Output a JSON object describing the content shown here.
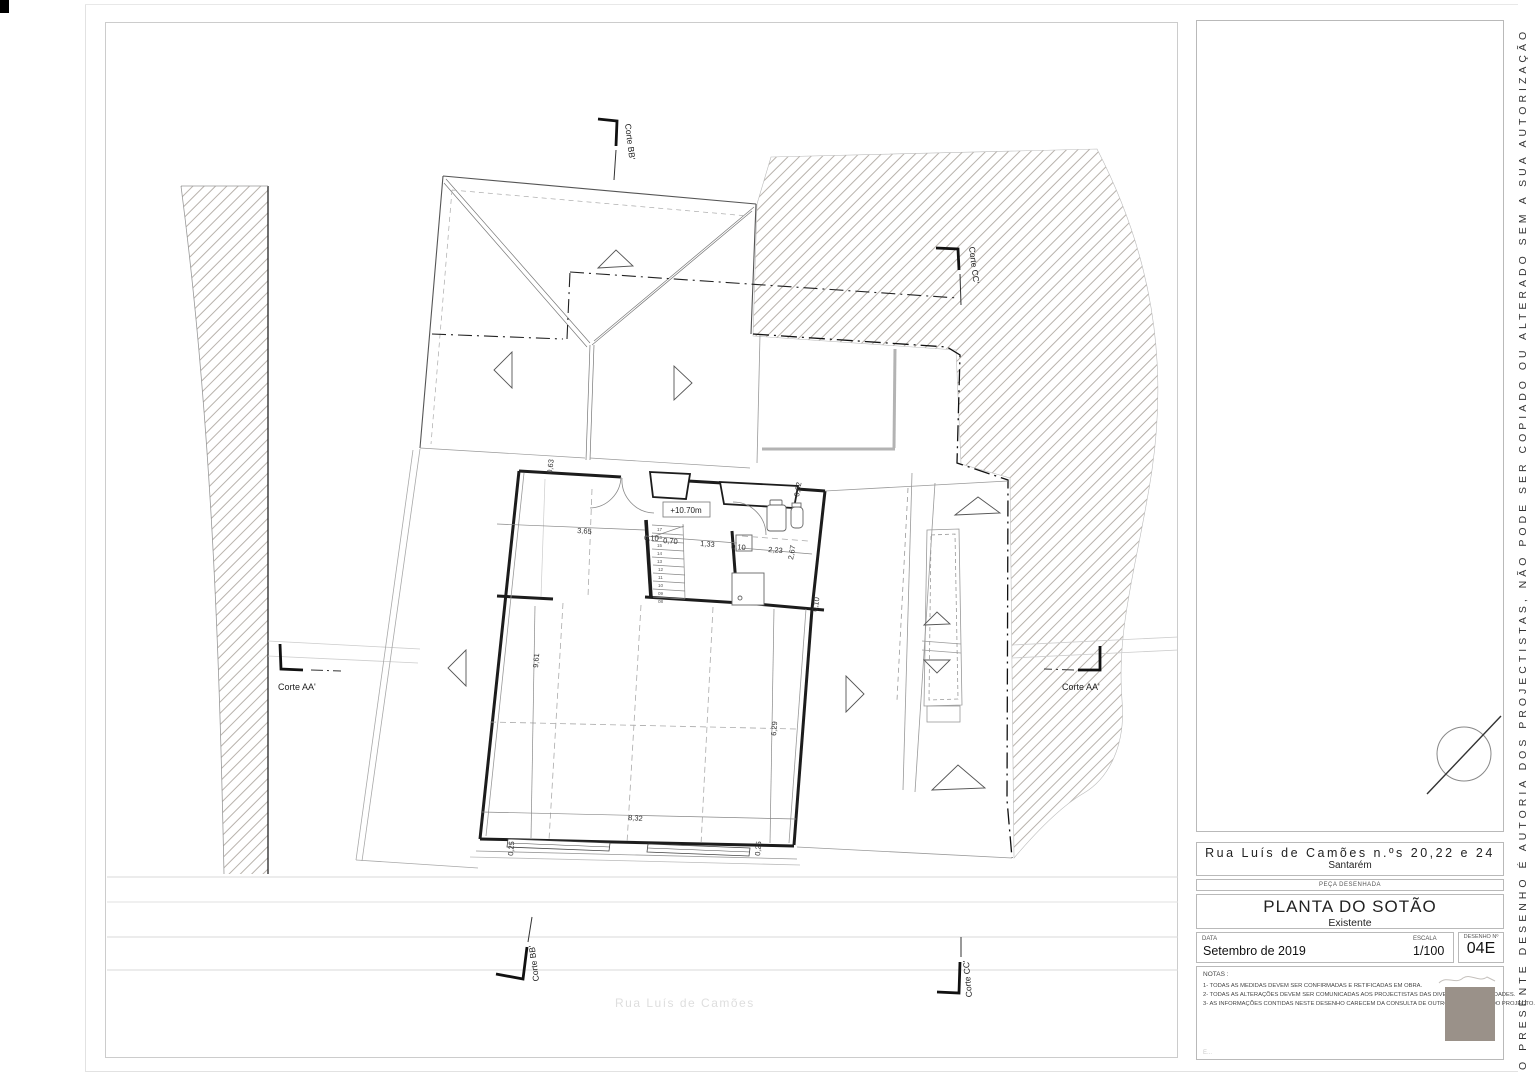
{
  "page": {
    "side_disclaimer": "O PRESENTE DESENHO É AUTORIA DOS PROJECTISTAS, NÃO PODE SER COPIADO OU ALTERADO SEM A SUA AUTORIZAÇÃO"
  },
  "titleblock": {
    "address_line1": "Rua Luís de Camões n.ºs 20,22 e 24",
    "address_city": "Santarém",
    "peca_label": "PEÇA DESENHADA",
    "title": "PLANTA DO SOTÃO",
    "subtitle": "Existente",
    "date_label": "DATA",
    "date_value": "Setembro de 2019",
    "scale_label": "ESCALA",
    "scale_value": "1/100",
    "drawing_no_label": "DESENHO Nº",
    "drawing_no_value": "04E",
    "notes_label": "NOTAS :",
    "notes": [
      "1- TODAS AS MEDIDAS DEVEM SER CONFIRMADAS E RETIFICADAS EM OBRA.",
      "2- TODAS AS ALTERAÇÕES DEVEM SER COMUNICADAS AOS PROJECTISTAS DAS DIVERSAS ESPECIALIDADES.",
      "3- AS INFORMAÇÕES CONTIDAS NESTE DESENHO CARECEM DA CONSULTA DE OUTROS ELEMENTOS DO PROJECTO."
    ],
    "footer_hint": "E..."
  },
  "plan": {
    "level_label": "+10.70m",
    "street_label": "Rua Luís de Camões",
    "sections": {
      "bb": "Corte BB'",
      "cc": "Corte CC'",
      "aa": "Corte AA'"
    },
    "stairs": [
      "17",
      "16",
      "15",
      "14",
      "13",
      "12",
      "11",
      "10",
      "09",
      "08"
    ],
    "dims": {
      "w063": "0,63",
      "w365": "3,65",
      "w010": "0,10",
      "w070": "0,70",
      "w133": "1,33",
      "w010b": "0,10",
      "w223": "2,23",
      "w267": "2,67",
      "w062": "0,62",
      "w010c": "0,10",
      "w961": "9,61",
      "w629": "6,29",
      "w832": "8,32",
      "w025a": "0,25",
      "w025b": "0,25"
    }
  },
  "colors": {
    "stamp": "#9a9189",
    "hatch": "#b8b2ac",
    "wall": "#1c1c1c"
  }
}
